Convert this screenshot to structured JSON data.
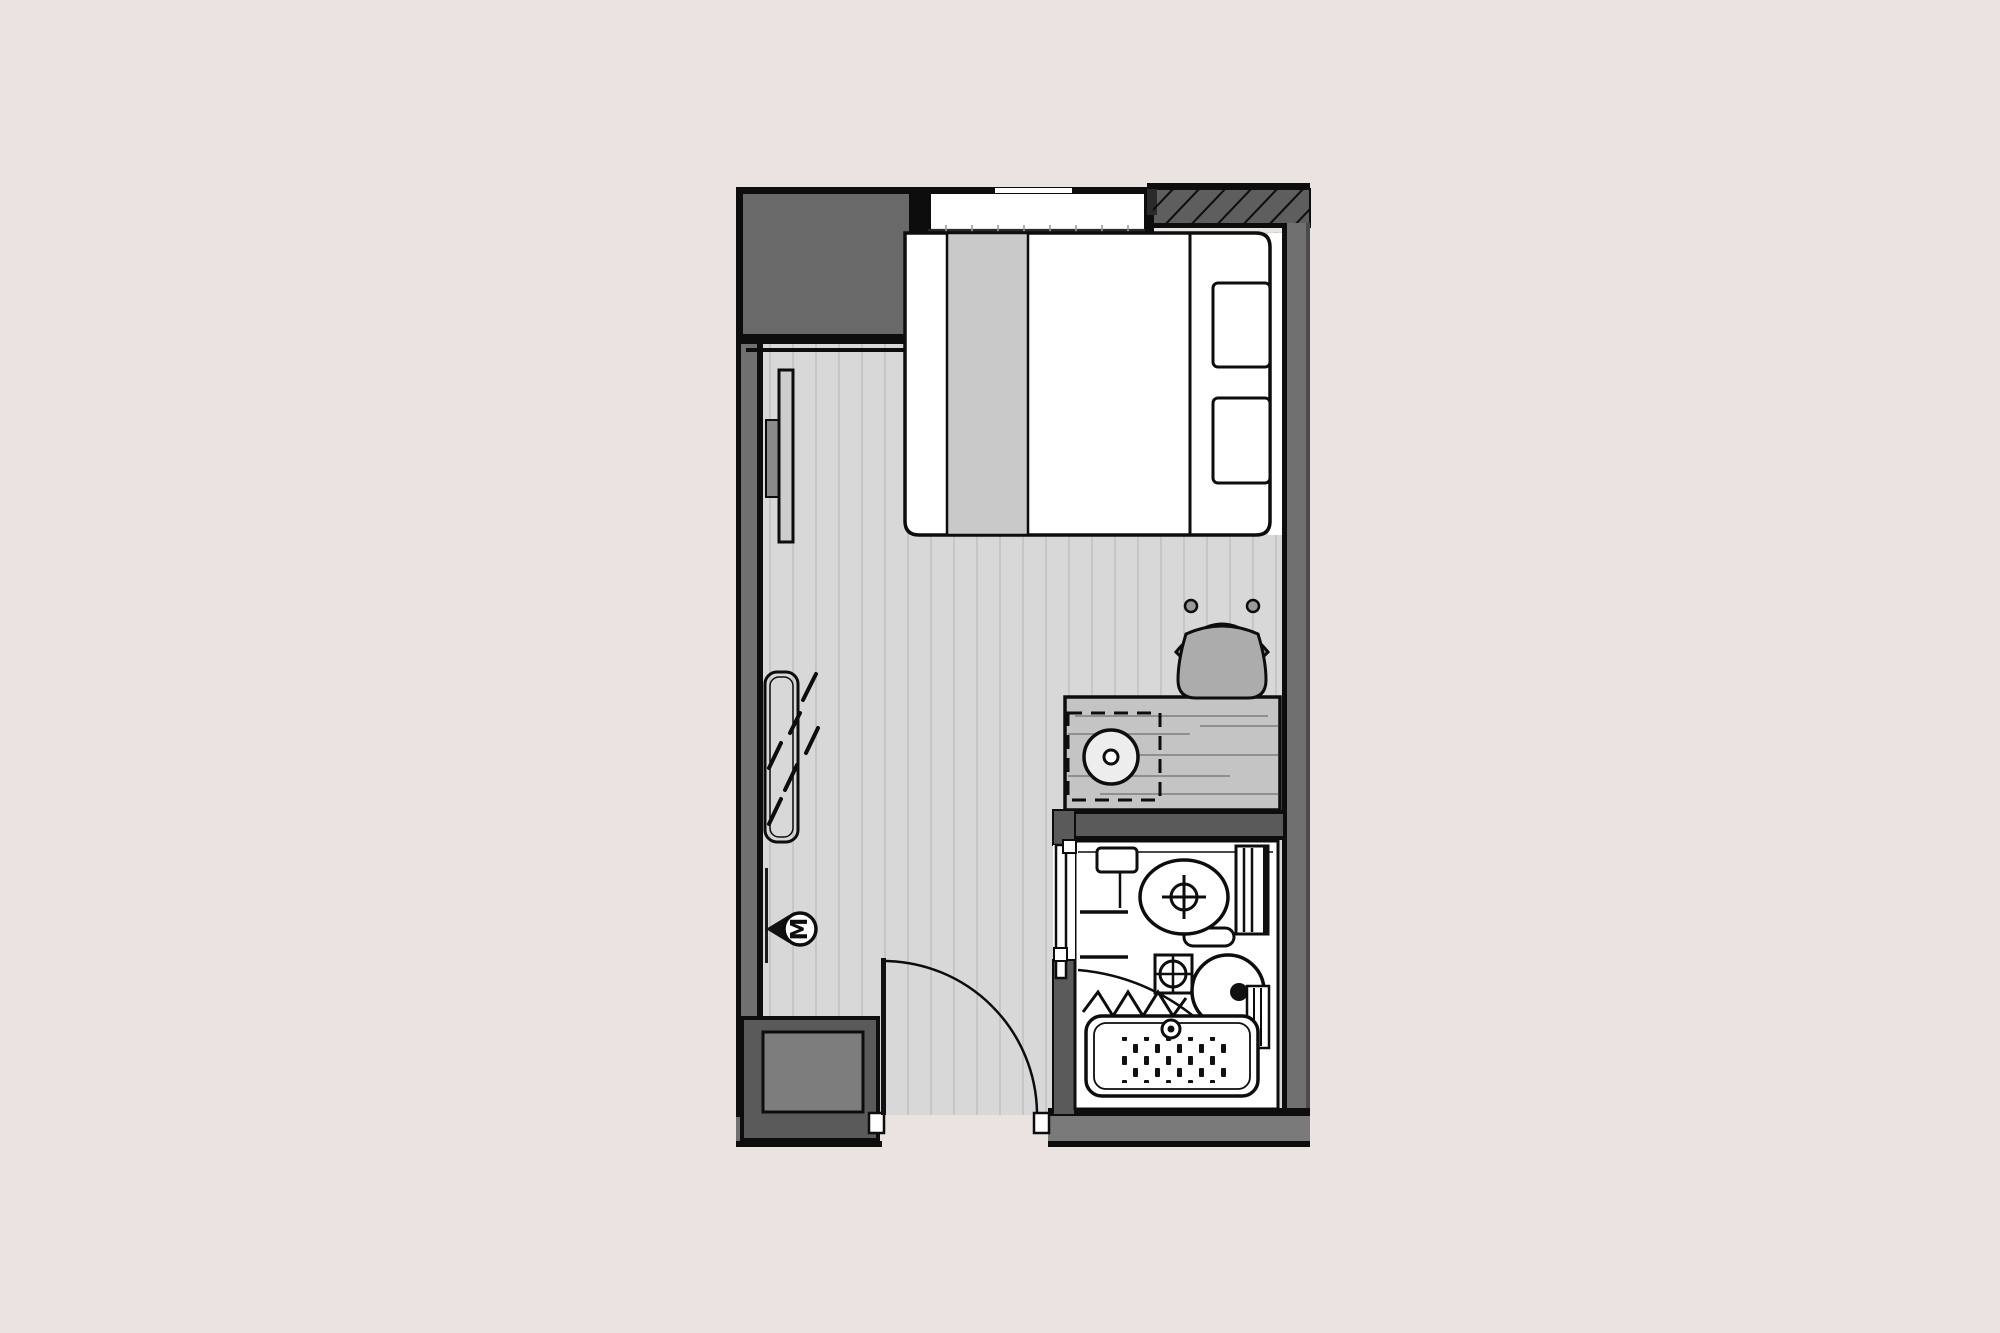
{
  "plan": {
    "marker_label": "M",
    "items": [
      "wardrobe",
      "window",
      "structural-wall-hatch",
      "double-bed",
      "bed-runner",
      "pillow",
      "pillow",
      "tv-panel",
      "mirror",
      "meter-marker",
      "desk",
      "under-desk-stool",
      "desk-chair",
      "bathroom",
      "toilet",
      "shelf",
      "radiator-rail",
      "grab-rails",
      "washbasin",
      "round-basin",
      "shower-curtain",
      "shower-tray",
      "entry-door",
      "bathroom-door",
      "service-riser"
    ],
    "colors": {
      "background": "#eae3df",
      "wall": "#707070",
      "wall-dark": "#5a5a5a",
      "wardrobe": "#696969",
      "floor": "#d8d8d8",
      "floor-stripe": "#c2c2c2",
      "bed-band": "#c9c9c9",
      "desk": "#c4c4c4",
      "desk-grain": "#8f8f8f",
      "chair-seat": "#acacac",
      "chair-back": "#9a9a9a",
      "stool": "#ededed",
      "riser-inner": "#7d7d7d",
      "line": "#0d0d0d",
      "white": "#ffffff"
    }
  }
}
